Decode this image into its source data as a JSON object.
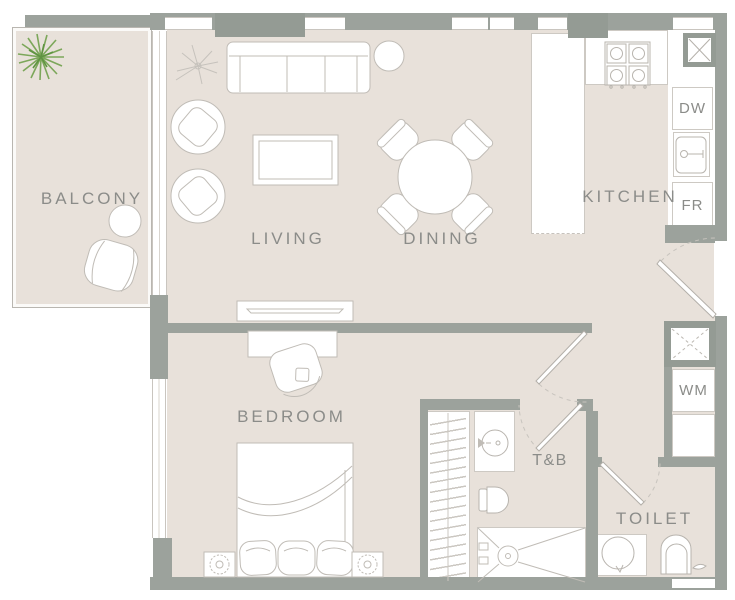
{
  "floorplan": {
    "rooms": [
      {
        "id": "balcony",
        "label": "BALCONY"
      },
      {
        "id": "living",
        "label": "LIVING"
      },
      {
        "id": "dining",
        "label": "DINING"
      },
      {
        "id": "kitchen",
        "label": "KITCHEN"
      },
      {
        "id": "bedroom",
        "label": "BEDROOM"
      },
      {
        "id": "toilet-and-bath",
        "label": "T&B"
      },
      {
        "id": "toilet",
        "label": "TOILET"
      }
    ],
    "appliances": [
      {
        "id": "dishwasher",
        "label": "DW"
      },
      {
        "id": "fridge",
        "label": "FR"
      },
      {
        "id": "washing-machine",
        "label": "WM"
      }
    ],
    "colors": {
      "floor": "#e8e1da",
      "wall": "#9ca29c",
      "fixture_line": "#c0bcb6",
      "label_text": "#8b8c89",
      "plant_green": "#7ca75a"
    }
  }
}
